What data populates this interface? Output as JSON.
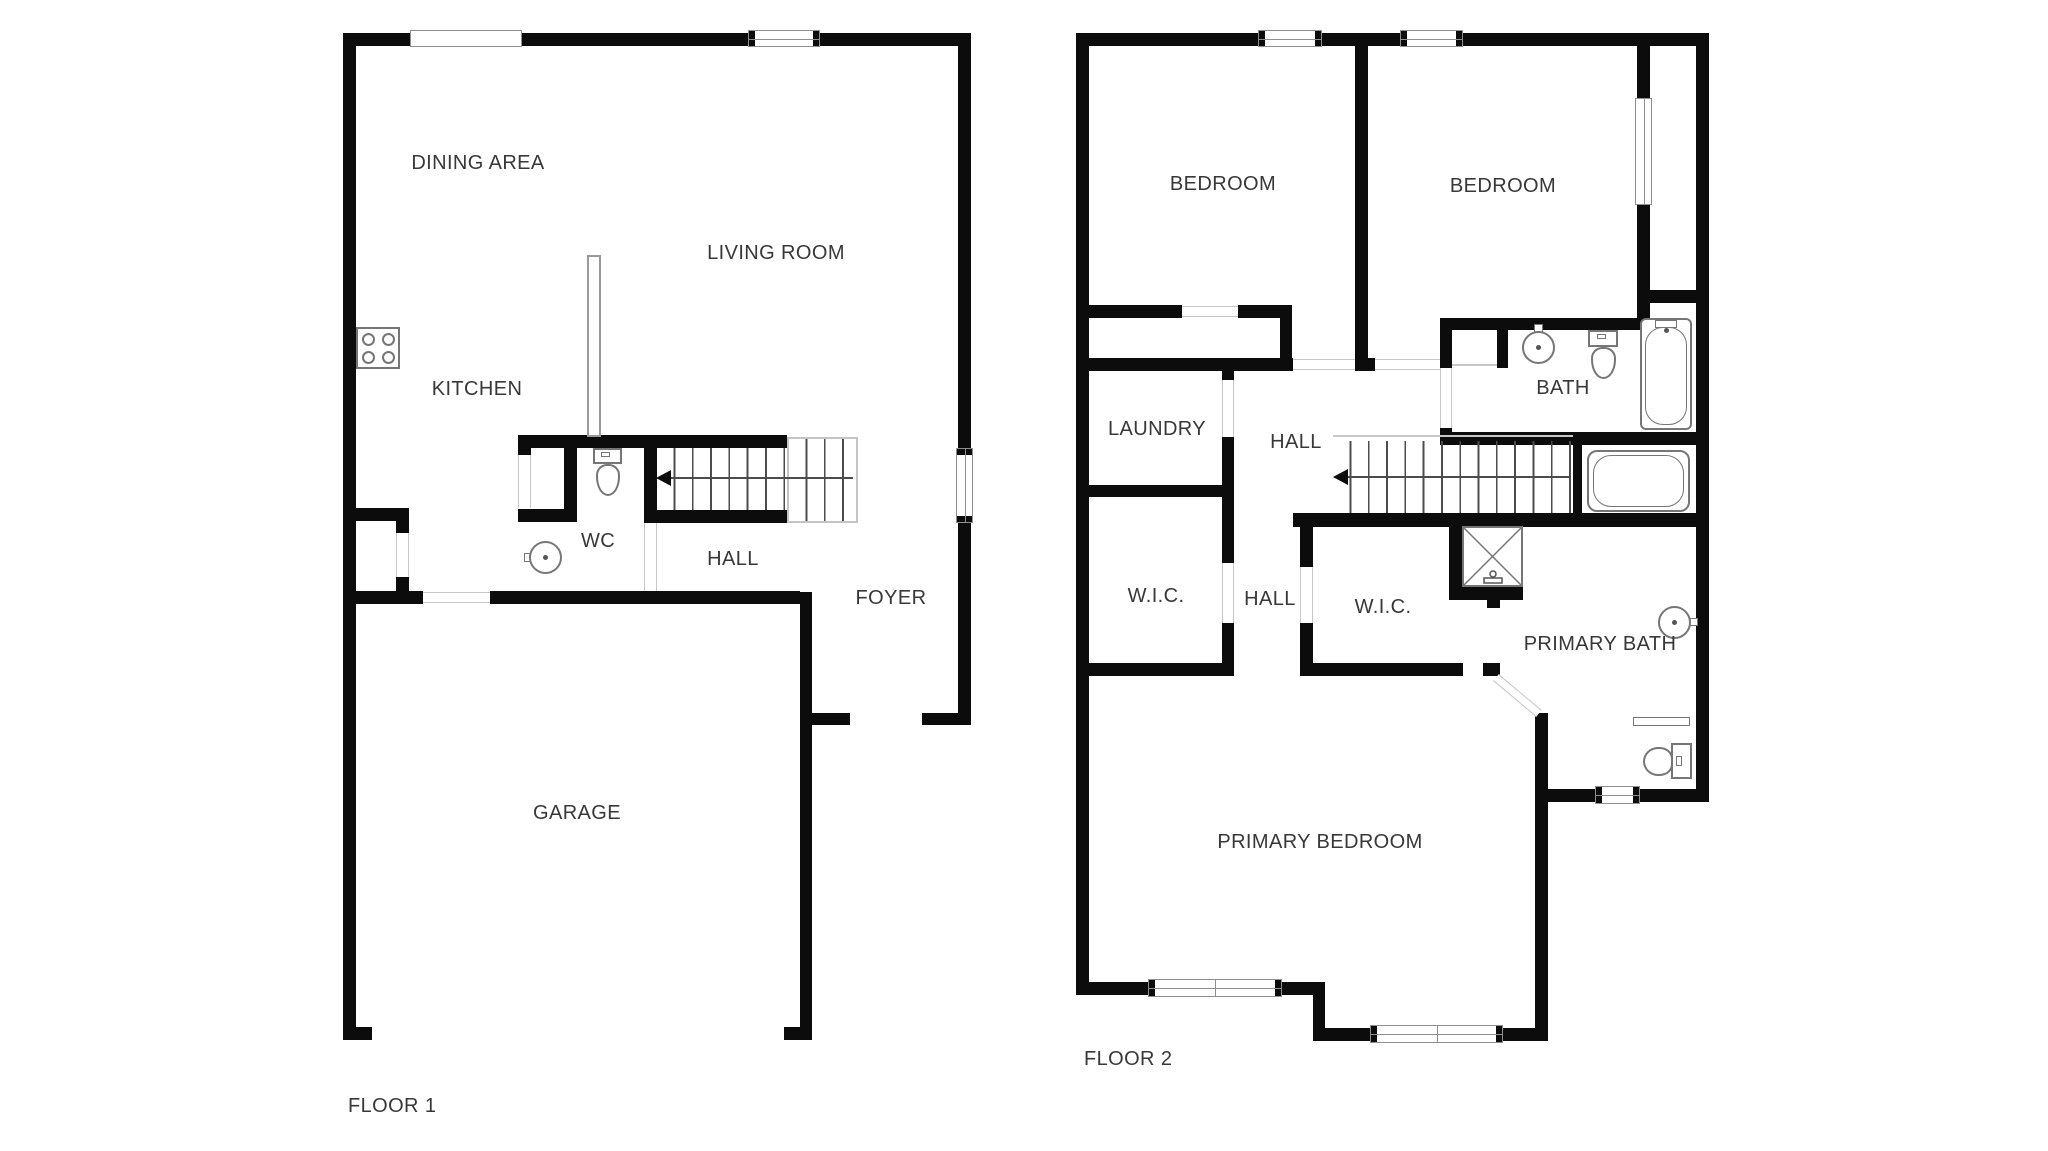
{
  "title": "Two-story house floor plan",
  "colors": {
    "background": "#ffffff",
    "wall": "#0c0c0c",
    "door_line": "#c7c7c7",
    "window_border": "#8f8f8f",
    "fixture_line": "#767676",
    "stair_line": "#4c4c4c",
    "text": "#383838"
  },
  "floor1": {
    "label": "FLOOR 1",
    "rooms": [
      {
        "label": "DINING AREA"
      },
      {
        "label": "LIVING ROOM"
      },
      {
        "label": "KITCHEN"
      },
      {
        "label": "WC"
      },
      {
        "label": "HALL"
      },
      {
        "label": "FOYER"
      },
      {
        "label": "GARAGE"
      }
    ],
    "fixtures": [
      "stove-icon",
      "toilet-icon",
      "sink-icon",
      "staircase-up"
    ]
  },
  "floor2": {
    "label": "FLOOR 2",
    "rooms": [
      {
        "label": "BEDROOM"
      },
      {
        "label": "BEDROOM"
      },
      {
        "label": "LAUNDRY"
      },
      {
        "label": "HALL"
      },
      {
        "label": "BATH"
      },
      {
        "label": "W.I.C."
      },
      {
        "label": "HALL"
      },
      {
        "label": "W.I.C."
      },
      {
        "label": "PRIMARY BATH"
      },
      {
        "label": "PRIMARY BEDROOM"
      }
    ],
    "fixtures": [
      "sink-icon",
      "toilet-icon",
      "bathtub-icon",
      "soaking-tub-icon",
      "shower-icon",
      "towel-shelf-icon",
      "sink-icon",
      "toilet-icon",
      "staircase-down"
    ]
  }
}
